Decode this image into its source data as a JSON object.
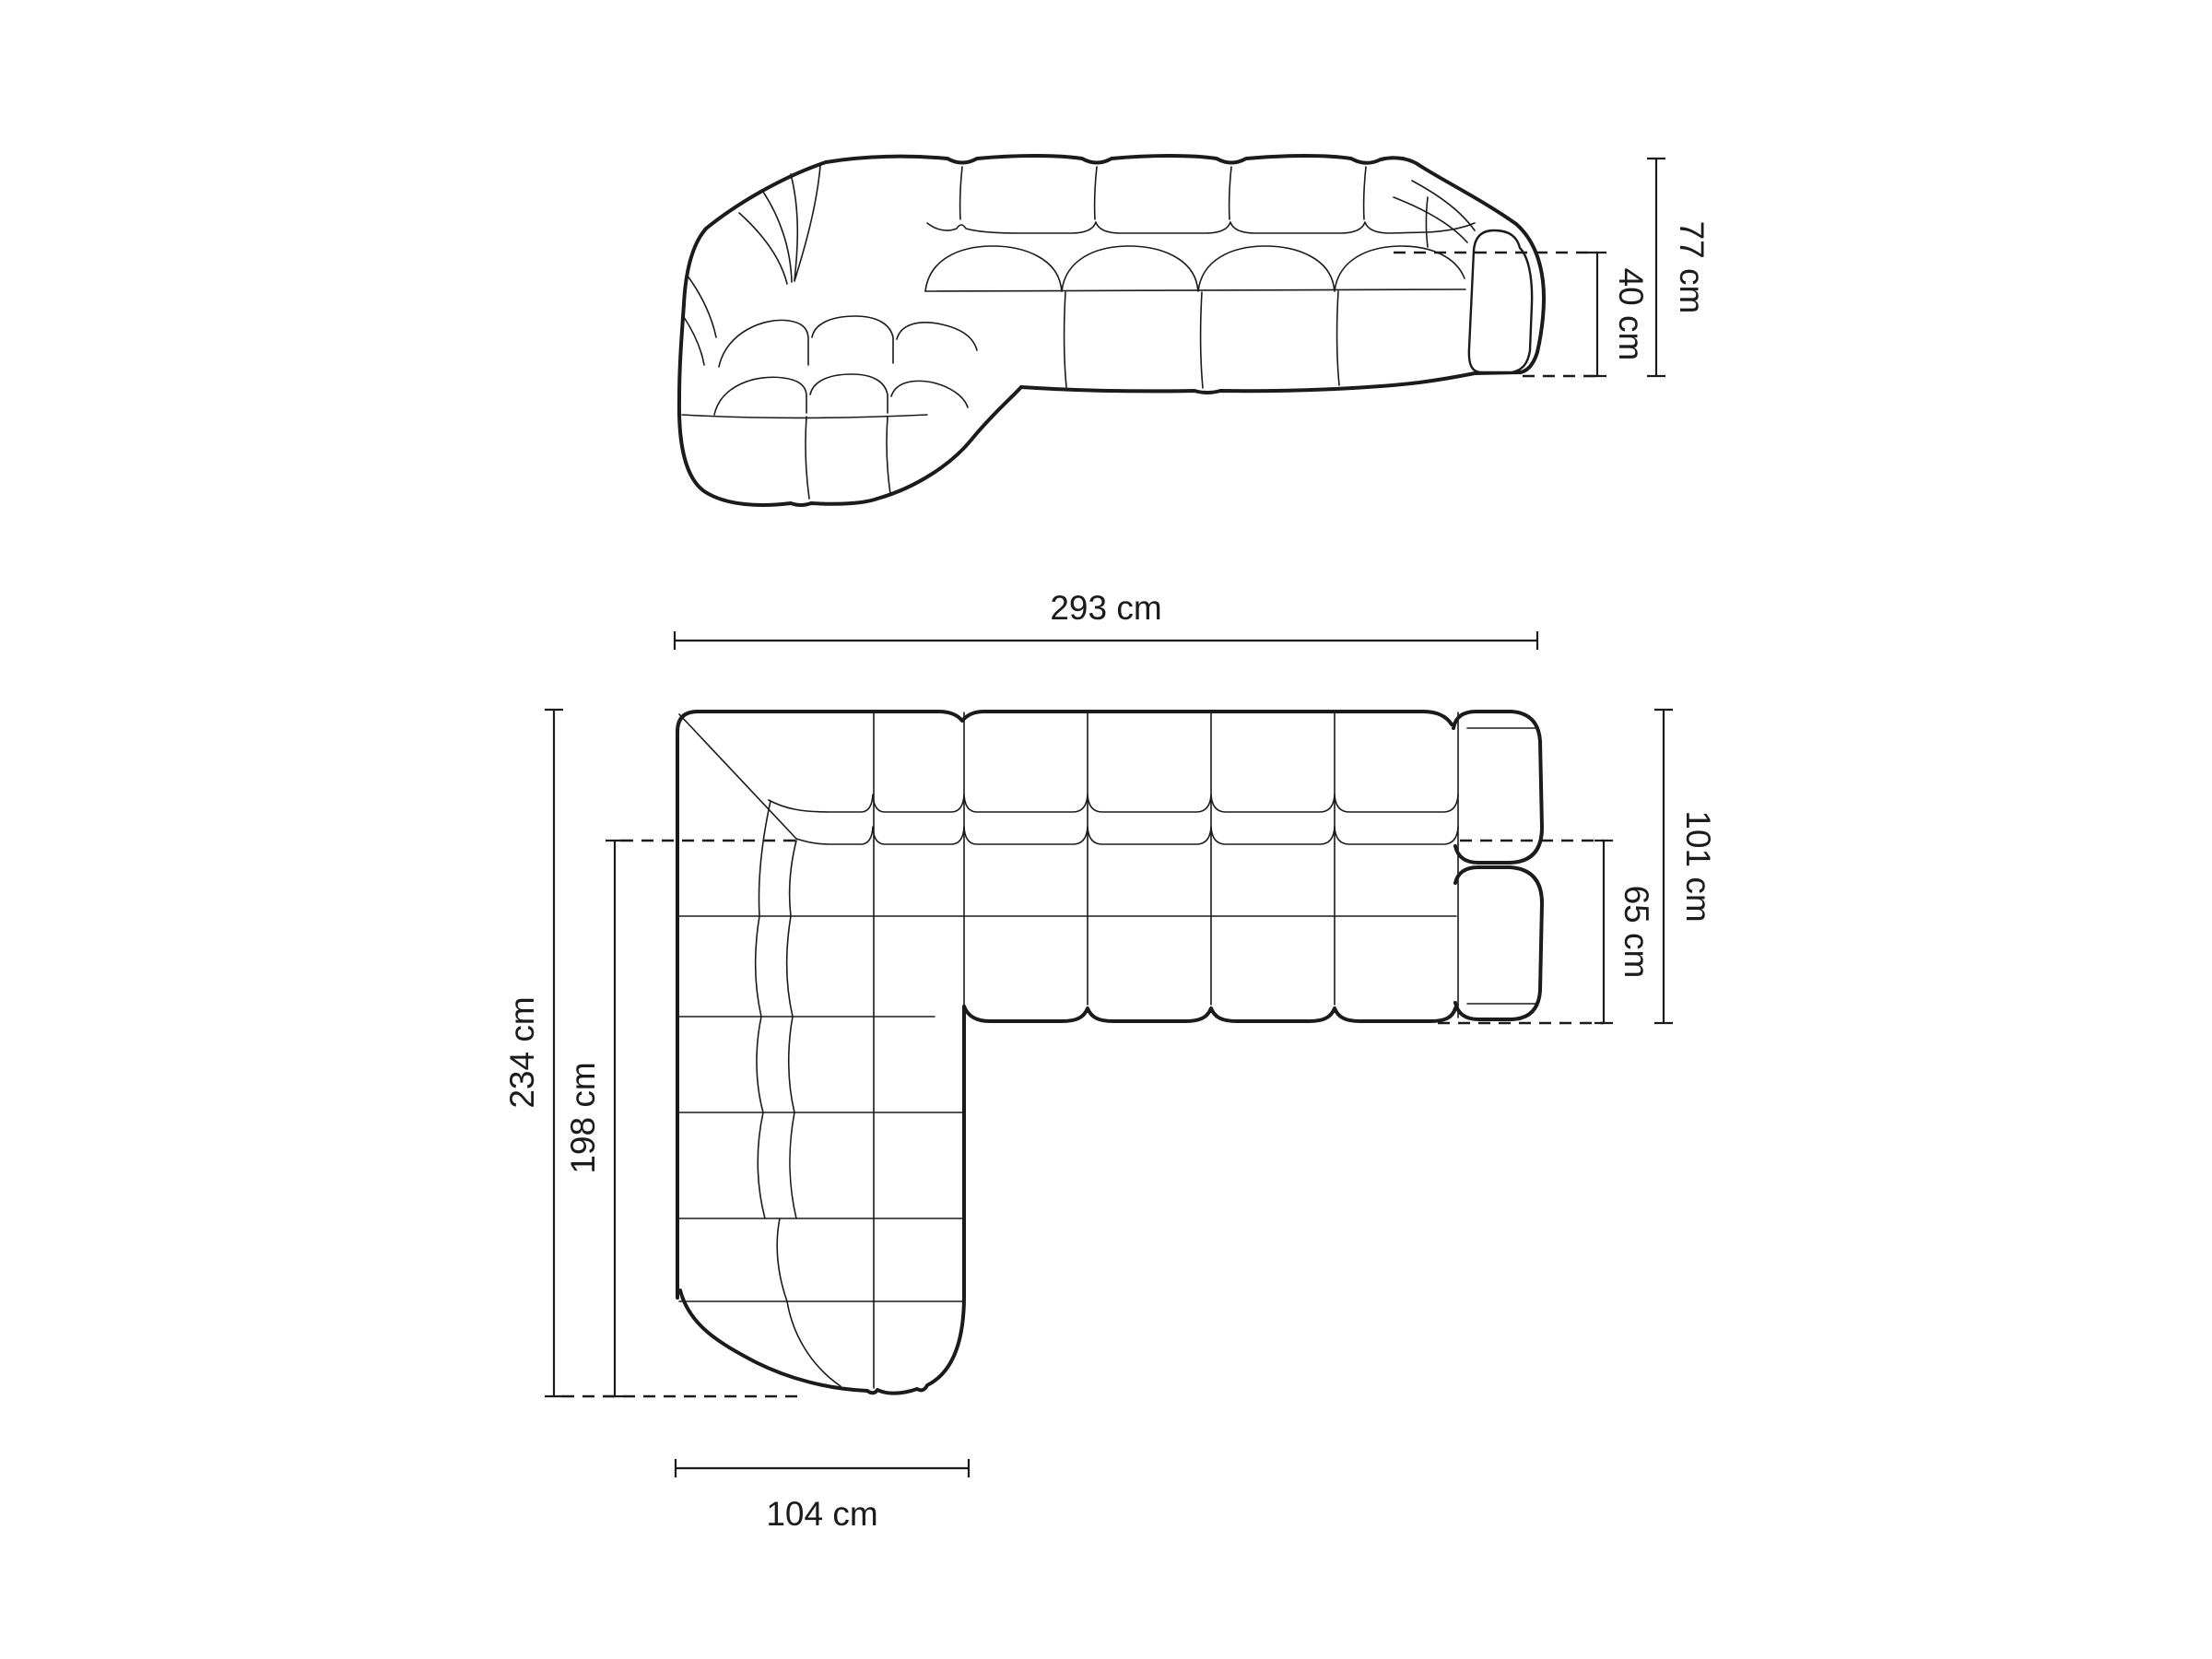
{
  "page": {
    "background": "#ffffff",
    "line_color": "#1b1b1b",
    "content": "technical dimension drawing of a modular corner sofa, front elevation above and top plan below"
  },
  "views": {
    "front": {
      "dims": {
        "height": "77 cm",
        "seat_height": "40 cm"
      }
    },
    "top": {
      "dims": {
        "total_width": "293 cm",
        "total_depth": "101 cm",
        "seat_depth": "65 cm",
        "total_length": "234 cm",
        "inner_length": "198 cm",
        "chaise_width": "104 cm"
      }
    }
  }
}
